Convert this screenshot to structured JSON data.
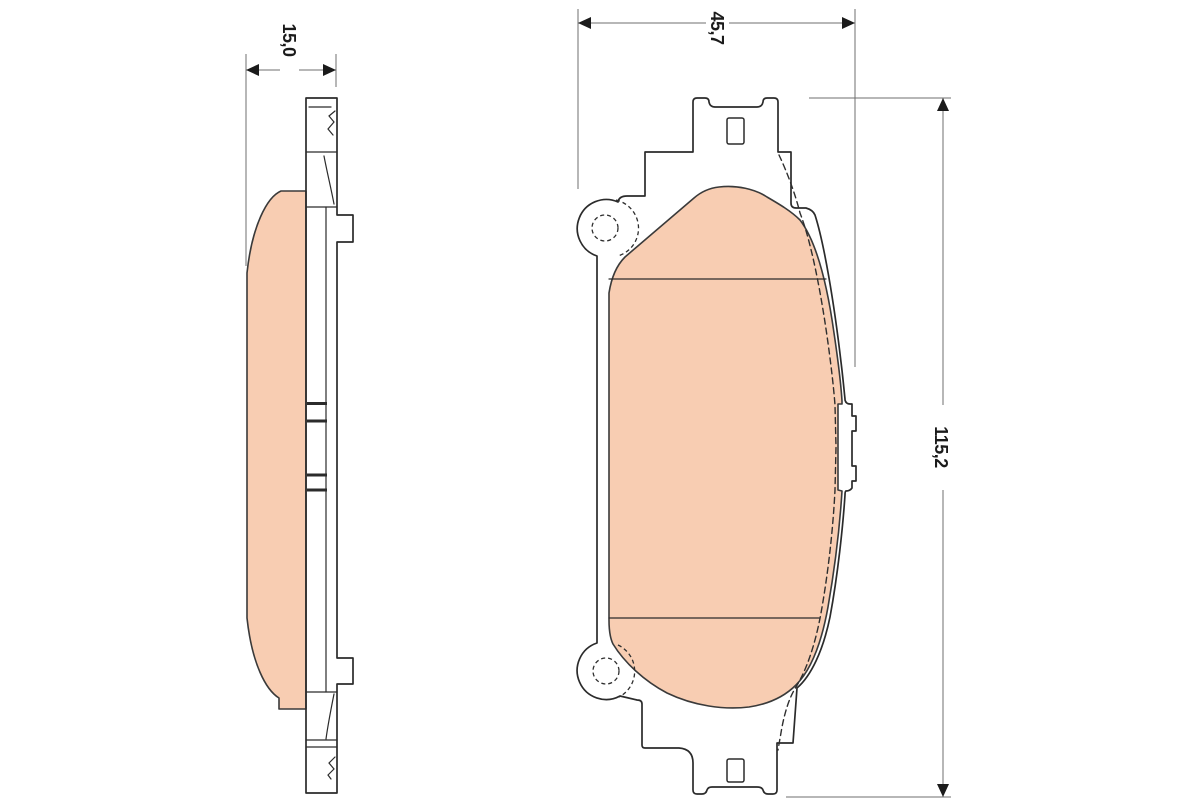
{
  "drawing": {
    "kind": "brake-pad-technical-drawing",
    "dimensions": {
      "thickness": {
        "label": "15,0"
      },
      "width": {
        "label": "45,7"
      },
      "height": {
        "label": "115,2"
      }
    },
    "colors": {
      "friction_fill": "#f8cdb2",
      "outline": "#2b2b2b",
      "dimension_line": "#6f6f6f",
      "text": "#1b1b1b",
      "background": "#ffffff"
    }
  }
}
